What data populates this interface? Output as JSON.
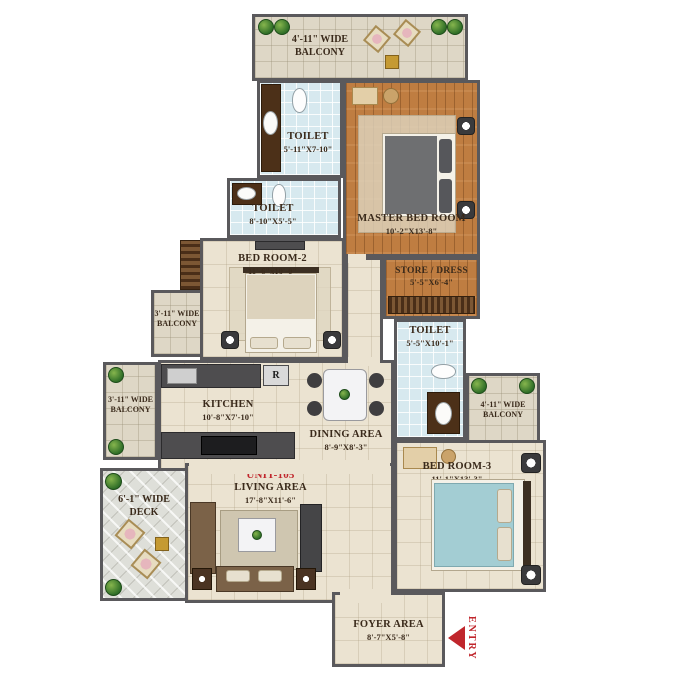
{
  "unit_label": "UNIT-105",
  "entry_label": "ENTRY",
  "refrigerator_label": "R",
  "rooms": {
    "balcony_top": {
      "line1": "4'-11\" WIDE",
      "line2": "BALCONY"
    },
    "toilet_1": {
      "name": "TOILET",
      "dims": "5'-11\"X7-10\""
    },
    "master_bedroom": {
      "name": "MASTER BED ROOM",
      "dims": "10'-2\"X13'-8\""
    },
    "toilet_2": {
      "name": "TOILET",
      "dims": "8'-10\"X5'-5\""
    },
    "store_dress": {
      "name": "STORE / DRESS",
      "dims": "5'-5\"X6'-4\""
    },
    "bedroom_2": {
      "name": "BED ROOM-2",
      "dims": "11'-6\"x10'-0\""
    },
    "balcony_left_upper": {
      "line1": "3'-11\" WIDE",
      "line2": "BALCONY"
    },
    "toilet_3": {
      "name": "TOILET",
      "dims": "5'-5\"X10'-1\""
    },
    "kitchen": {
      "name": "KITCHEN",
      "dims": "10'-8\"X7'-10\""
    },
    "dining": {
      "name": "DINING AREA",
      "dims": "8'-9\"X8'-3\""
    },
    "balcony_left_lower": {
      "line1": "3'-11\" WIDE",
      "line2": "BALCONY"
    },
    "balcony_right": {
      "line1": "4'-11\" WIDE",
      "line2": "BALCONY"
    },
    "bedroom_3": {
      "name": "BED ROOM-3",
      "dims": "11'-1\"X13'-3\""
    },
    "deck": {
      "line1": "6'-1\" WIDE",
      "line2": "DECK"
    },
    "living": {
      "name": "LIVING AREA",
      "dims": "17'-8\"X11'-6\""
    },
    "foyer": {
      "name": "FOYER AREA",
      "dims": "8'-7\"X5'-8\""
    }
  },
  "colors": {
    "wall": "#5a595c",
    "floor_cream": "#ebe3d1",
    "floor_wood": "#bf7d41",
    "toilet_tile": "#d7e9ef",
    "balcony_tile": "#ded7c6",
    "deck": "#dedfd9",
    "accent_red": "#c0262c",
    "label_text": "#3a2a1b"
  }
}
